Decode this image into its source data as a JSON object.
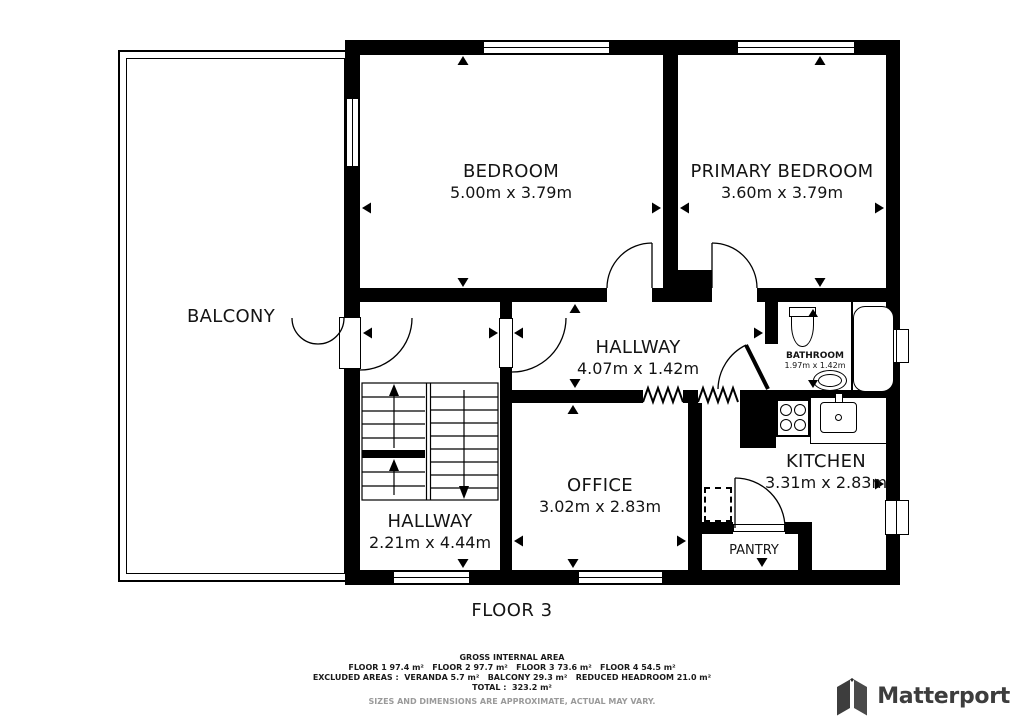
{
  "plan": {
    "floor_label": "FLOOR 3",
    "rooms": {
      "balcony": {
        "name": "BALCONY"
      },
      "bedroom": {
        "name": "BEDROOM",
        "dims": "5.00m x 3.79m"
      },
      "primary_bedroom": {
        "name": "PRIMARY BEDROOM",
        "dims": "3.60m x 3.79m"
      },
      "hallway_upper": {
        "name": "HALLWAY",
        "dims": "4.07m x 1.42m"
      },
      "bathroom": {
        "name": "BATHROOM",
        "dims": "1.97m x 1.42m"
      },
      "kitchen": {
        "name": "KITCHEN",
        "dims": "3.31m x 2.83m"
      },
      "office": {
        "name": "OFFICE",
        "dims": "3.02m x 2.83m"
      },
      "hallway_lower": {
        "name": "HALLWAY",
        "dims": "2.21m x 4.44m"
      },
      "pantry": {
        "name": "PANTRY"
      }
    },
    "icons": {
      "stairs": "stairs-up-down",
      "zigzag": "reduced-headroom-marker",
      "fixtures": [
        "toilet",
        "bathroom-sink",
        "bathtub",
        "stove",
        "kitchen-sink"
      ]
    }
  },
  "footer": {
    "title": "GROSS INTERNAL AREA",
    "floor_areas": "FLOOR 1 97.4 m²   FLOOR 2 97.7 m²   FLOOR 3 73.6 m²   FLOOR 4 54.5 m²",
    "excluded_areas": "EXCLUDED AREAS :  VERANDA 5.7 m²   BALCONY 29.3 m²   REDUCED HEADROOM 21.0 m²",
    "total": "TOTAL :  323.2 m²",
    "disclaimer": "SIZES AND DIMENSIONS ARE APPROXIMATE, ACTUAL MAY VARY."
  },
  "branding": {
    "logo_text": "Matterport"
  },
  "colors": {
    "wall": "#000000",
    "background": "#ffffff",
    "logo_gray": "#3d3d3d",
    "disclaimer_gray": "#9a9a9a"
  }
}
